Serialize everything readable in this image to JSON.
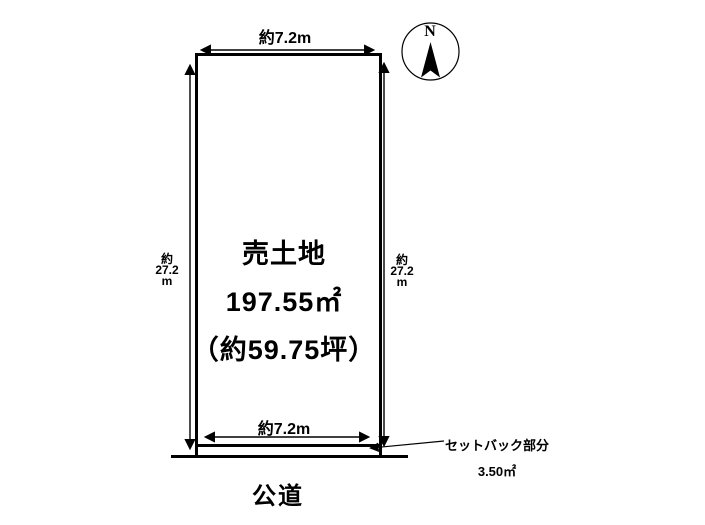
{
  "diagram": {
    "type": "real-estate-lot-plan",
    "plot": {
      "title": "売土地",
      "area": "197.55㎡",
      "tsubo": "（約59.75坪）"
    },
    "dimensions": {
      "top_width": "約7.2m",
      "bottom_width": "約7.2m",
      "left_depth": "約\n27.2\nm",
      "right_depth": "約\n27.2\nm"
    },
    "setback": {
      "line1": "セットバック部分",
      "line2": "3.50㎡"
    },
    "road": {
      "label": "公道"
    },
    "compass": {
      "label": "N"
    },
    "colors": {
      "line": "#000000",
      "background": "#ffffff"
    }
  }
}
